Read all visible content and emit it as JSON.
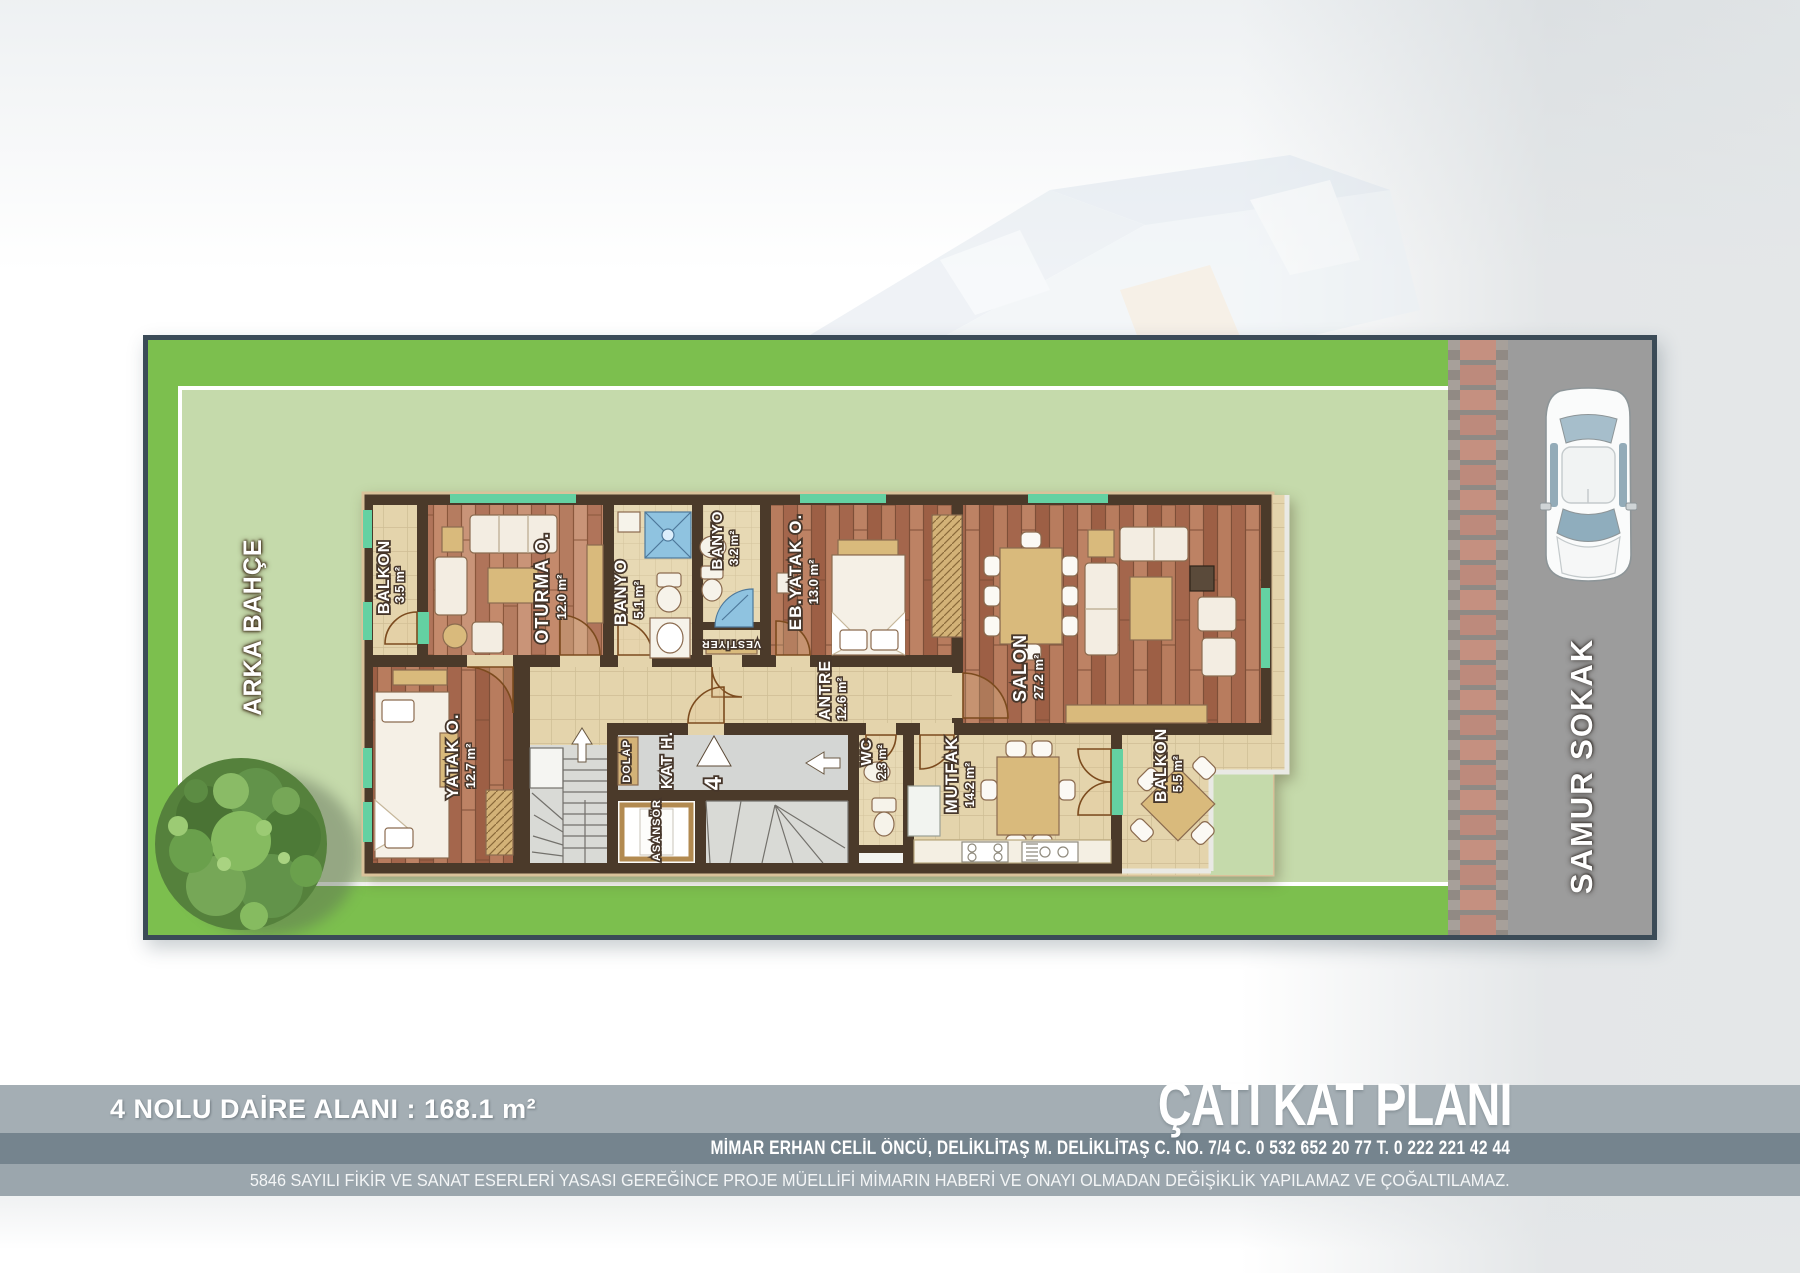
{
  "page": {
    "area_label": "4 NOLU DAİRE ALANI : 168.1 m²",
    "title": "ÇATI KAT PLANI",
    "architect_line": "MİMAR ERHAN CELİL ÖNCÜ,  DELİKLİTAŞ M. DELİKLİTAŞ C. NO. 7/4   C. 0 532 652 20 77   T. 0 222 221 42 44",
    "legal_line": "5846 SAYILI FİKİR VE SANAT ESERLERİ YASASI GEREĞİNCE PROJE MÜELLİFİ MİMARIN HABERİ VE ONAYI OLMADAN DEĞİŞİKLİK YAPILAMAZ VE ÇOĞALTILAMAZ."
  },
  "site": {
    "back_garden_label": "ARKA BAHÇE",
    "street_label": "SAMUR SOKAK"
  },
  "plan": {
    "unit_number": "4",
    "rooms": [
      {
        "name": "BALKON",
        "area": "3.5 m²"
      },
      {
        "name": "OTURMA O.",
        "area": "12.0 m²"
      },
      {
        "name": "BANYO",
        "area": "5.1 m²"
      },
      {
        "name": "BANYO",
        "area": "3.2 m²"
      },
      {
        "name": "VESTİYER",
        "area": ""
      },
      {
        "name": "EB.YATAK O.",
        "area": "13.0 m²"
      },
      {
        "name": "SALON",
        "area": "27.2 m²"
      },
      {
        "name": "ANTRE",
        "area": "12.6 m²"
      },
      {
        "name": "YATAK O.",
        "area": "12.7 m²"
      },
      {
        "name": "KAT H.",
        "area": ""
      },
      {
        "name": "DOLAP",
        "area": ""
      },
      {
        "name": "ASANSÖR",
        "area": ""
      },
      {
        "name": "WC",
        "area": "2.3 m²"
      },
      {
        "name": "MUTFAK",
        "area": "14.2 m²"
      },
      {
        "name": "BALKON",
        "area": "5.5 m²"
      }
    ],
    "colors": {
      "lawn_bright": "#7cbf4e",
      "lawn_light": "#c5daab",
      "frame_border": "#3b4b57",
      "road": "#9c9c9c",
      "paver_pink": "#c59080",
      "wall": "#4b3a2a",
      "wood": "#b5755a",
      "tile": "#e4d4ac",
      "window_teal": "#64d1a2",
      "stair_gray": "#d9dad6",
      "band_gray": "#a4aeb4",
      "band_dark": "#75848e"
    }
  }
}
